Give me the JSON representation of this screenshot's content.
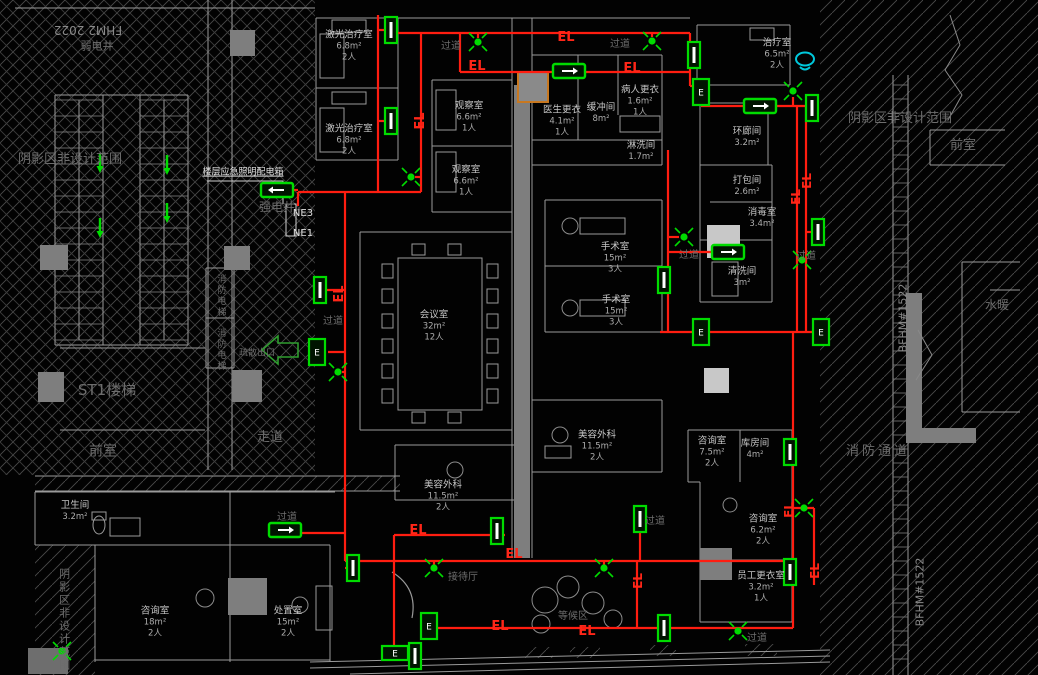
{
  "drawing": {
    "type": "emergency-lighting-floor-plan",
    "circuit_tag": "EL",
    "panel_label": "楼层应急照明配电箱",
    "feeders": [
      "NE3",
      "NE1"
    ]
  },
  "colors": {
    "circuit": "#ff1d10",
    "symbol_green": "#00dc00",
    "wall": "#9a9a9a",
    "hatch": "#4a4a4a",
    "cyan_marker": "#00c8dc",
    "orange_block": "#c87820",
    "room_text": "#c6c6c6",
    "zone_text": "#6d6d6d"
  },
  "rooms": [
    {
      "n": "激光治疗室",
      "a": "6.8m²",
      "p": "2人",
      "x": 349,
      "y": 46
    },
    {
      "n": "激光治疗室",
      "a": "6.8m²",
      "p": "2人",
      "x": 349,
      "y": 140
    },
    {
      "n": "观察室",
      "a": "6.6m²",
      "p": "1人",
      "x": 469,
      "y": 117
    },
    {
      "n": "观察室",
      "a": "6.6m²",
      "p": "1人",
      "x": 466,
      "y": 181
    },
    {
      "n": "医生更衣",
      "a": "4.1m²",
      "p": "1人",
      "x": 562,
      "y": 121
    },
    {
      "n": "缓冲间",
      "a": "8m²",
      "p": "",
      "x": 601,
      "y": 113
    },
    {
      "n": "病人更衣",
      "a": "1.6m²",
      "p": "1人",
      "x": 640,
      "y": 101
    },
    {
      "n": "淋洗间",
      "a": "1.7m²",
      "p": "",
      "x": 641,
      "y": 151
    },
    {
      "n": "治疗室",
      "a": "6.5m²",
      "p": "2人",
      "x": 777,
      "y": 54
    },
    {
      "n": "环廊间",
      "a": "3.2m²",
      "p": "",
      "x": 747,
      "y": 137
    },
    {
      "n": "打包间",
      "a": "2.6m²",
      "p": "",
      "x": 747,
      "y": 186
    },
    {
      "n": "消毒室",
      "a": "3.4m²",
      "p": "",
      "x": 762,
      "y": 218
    },
    {
      "n": "清洗间",
      "a": "3m²",
      "p": "",
      "x": 742,
      "y": 277
    },
    {
      "n": "手术室",
      "a": "15m²",
      "p": "3人",
      "x": 615,
      "y": 258
    },
    {
      "n": "手术室",
      "a": "15m²",
      "p": "3人",
      "x": 616,
      "y": 311
    },
    {
      "n": "会议室",
      "a": "32m²",
      "p": "12人",
      "x": 434,
      "y": 326
    },
    {
      "n": "美容外科",
      "a": "11.5m²",
      "p": "2人",
      "x": 597,
      "y": 446
    },
    {
      "n": "美容外科",
      "a": "11.5m²",
      "p": "2人",
      "x": 443,
      "y": 496
    },
    {
      "n": "咨询室",
      "a": "7.5m²",
      "p": "2人",
      "x": 712,
      "y": 452
    },
    {
      "n": "库房间",
      "a": "4m²",
      "p": "",
      "x": 755,
      "y": 449
    },
    {
      "n": "咨询室",
      "a": "6.2m²",
      "p": "2人",
      "x": 763,
      "y": 530
    },
    {
      "n": "员工更衣室",
      "a": "3.2m²",
      "p": "1人",
      "x": 761,
      "y": 587
    },
    {
      "n": "卫生间",
      "a": "3.2m²",
      "p": "",
      "x": 75,
      "y": 511
    },
    {
      "n": "咨询室",
      "a": "18m²",
      "p": "2人",
      "x": 155,
      "y": 622
    },
    {
      "n": "处置室",
      "a": "15m²",
      "p": "2人",
      "x": 288,
      "y": 622
    }
  ],
  "labels": [
    {
      "t": "阴影区非设计范围",
      "k": "zone",
      "s": 13,
      "x": 70,
      "y": 160
    },
    {
      "t": "阴影区非设计范围",
      "k": "zone",
      "s": 13,
      "x": 900,
      "y": 119
    },
    {
      "t": "阴影区非设计范围",
      "k": "zone",
      "s": 11,
      "x": 64,
      "y": 620,
      "vert": true
    },
    {
      "t": "前室",
      "k": "zone",
      "s": 13,
      "x": 963,
      "y": 146
    },
    {
      "t": "前室",
      "k": "zone",
      "s": 14,
      "x": 103,
      "y": 452
    },
    {
      "t": "走道",
      "k": "zone",
      "s": 13,
      "x": 270,
      "y": 438
    },
    {
      "t": "ST1楼梯",
      "k": "zone",
      "s": 15,
      "x": 107,
      "y": 390
    },
    {
      "t": "消防通道",
      "k": "zone",
      "s": 13,
      "x": 878,
      "y": 452,
      "ls": 3
    },
    {
      "t": "水暖",
      "k": "zone",
      "s": 12,
      "x": 997,
      "y": 305
    },
    {
      "t": "弱电井",
      "k": "zone",
      "s": 11,
      "x": 97,
      "y": 46
    },
    {
      "t": "强电井",
      "k": "zone",
      "s": 12,
      "x": 277,
      "y": 207
    },
    {
      "t": "消防电梯",
      "k": "zone",
      "s": 9,
      "x": 220,
      "y": 296,
      "vert": true
    },
    {
      "t": "消防电梯",
      "k": "zone",
      "s": 9,
      "x": 220,
      "y": 350,
      "vert": true
    },
    {
      "t": "疏散出口",
      "k": "zone",
      "s": 9,
      "x": 257,
      "y": 354
    },
    {
      "t": "过道",
      "k": "zone",
      "s": 10,
      "x": 451,
      "y": 47
    },
    {
      "t": "过道",
      "k": "zone",
      "s": 10,
      "x": 620,
      "y": 45
    },
    {
      "t": "过道",
      "k": "zone",
      "s": 10,
      "x": 689,
      "y": 256
    },
    {
      "t": "过道",
      "k": "zone",
      "s": 10,
      "x": 806,
      "y": 257
    },
    {
      "t": "过道",
      "k": "zone",
      "s": 10,
      "x": 333,
      "y": 322
    },
    {
      "t": "过道",
      "k": "zone",
      "s": 10,
      "x": 287,
      "y": 518
    },
    {
      "t": "过道",
      "k": "zone",
      "s": 10,
      "x": 655,
      "y": 522
    },
    {
      "t": "过道",
      "k": "zone",
      "s": 10,
      "x": 757,
      "y": 639
    },
    {
      "t": "接待厅",
      "k": "zone",
      "s": 10,
      "x": 463,
      "y": 578
    },
    {
      "t": "等候区",
      "k": "zone",
      "s": 10,
      "x": 573,
      "y": 617
    },
    {
      "t": "FHM2 2022",
      "k": "dim",
      "s": 12,
      "x": 88,
      "y": 30,
      "rot": 180
    },
    {
      "t": "BFHM#1522",
      "k": "dim",
      "s": 11,
      "x": 903,
      "y": 318,
      "rot": -90
    },
    {
      "t": "BFHM#1522",
      "k": "dim",
      "s": 11,
      "x": 920,
      "y": 592,
      "rot": -90
    },
    {
      "t": "楼层应急照明配电箱",
      "k": "sys",
      "s": 9,
      "x": 243,
      "y": 173,
      "und": true
    },
    {
      "t": "NE3",
      "k": "sys",
      "s": 10,
      "x": 303,
      "y": 214
    },
    {
      "t": "NE1",
      "k": "sys",
      "s": 10,
      "x": 303,
      "y": 234
    },
    {
      "t": "EL",
      "k": "el",
      "s": 13,
      "x": 566,
      "y": 38
    },
    {
      "t": "EL",
      "k": "el",
      "s": 13,
      "x": 477,
      "y": 67
    },
    {
      "t": "EL",
      "k": "el",
      "s": 13,
      "x": 632,
      "y": 69
    },
    {
      "t": "EL",
      "k": "el",
      "s": 13,
      "x": 421,
      "y": 121,
      "rot": -90
    },
    {
      "t": "EL",
      "k": "el",
      "s": 13,
      "x": 340,
      "y": 294,
      "rot": -90
    },
    {
      "t": "EL",
      "k": "el",
      "s": 12,
      "x": 807,
      "y": 181,
      "rot": -90
    },
    {
      "t": "EL",
      "k": "el",
      "s": 12,
      "x": 796,
      "y": 197,
      "rot": -90
    },
    {
      "t": "EL",
      "k": "el",
      "s": 12,
      "x": 789,
      "y": 510,
      "rot": -90
    },
    {
      "t": "EL",
      "k": "el",
      "s": 12,
      "x": 815,
      "y": 571,
      "rot": -90
    },
    {
      "t": "EL",
      "k": "el",
      "s": 12,
      "x": 638,
      "y": 581,
      "rot": -90
    },
    {
      "t": "EL",
      "k": "el",
      "s": 13,
      "x": 514,
      "y": 555
    },
    {
      "t": "EL",
      "k": "el",
      "s": 13,
      "x": 500,
      "y": 627
    },
    {
      "t": "EL",
      "k": "el",
      "s": 13,
      "x": 587,
      "y": 632
    },
    {
      "t": "EL",
      "k": "el",
      "s": 13,
      "x": 418,
      "y": 531
    }
  ],
  "circuit_segments": [
    [
      378,
      15,
      378,
      192
    ],
    [
      421,
      33,
      421,
      192
    ],
    [
      298,
      192,
      421,
      192
    ],
    [
      298,
      192,
      298,
      206
    ],
    [
      298,
      190,
      285,
      190
    ],
    [
      395,
      33,
      690,
      33
    ],
    [
      460,
      33,
      460,
      72
    ],
    [
      460,
      72,
      690,
      72
    ],
    [
      690,
      33,
      690,
      72
    ],
    [
      690,
      72,
      690,
      86
    ],
    [
      690,
      86,
      701,
      86
    ],
    [
      701,
      98,
      701,
      106
    ],
    [
      701,
      106,
      806,
      106
    ],
    [
      797,
      106,
      797,
      332
    ],
    [
      806,
      106,
      806,
      332
    ],
    [
      668,
      150,
      668,
      332
    ],
    [
      660,
      332,
      830,
      332
    ],
    [
      793,
      332,
      793,
      628
    ],
    [
      427,
      628,
      793,
      628
    ],
    [
      637,
      561,
      637,
      628
    ],
    [
      394,
      561,
      793,
      561
    ],
    [
      394,
      535,
      505,
      535
    ],
    [
      394,
      535,
      394,
      655
    ],
    [
      345,
      192,
      345,
      533
    ],
    [
      345,
      533,
      300,
      533
    ],
    [
      345,
      533,
      345,
      561
    ],
    [
      345,
      561,
      394,
      561
    ],
    [
      640,
      527,
      640,
      561
    ],
    [
      793,
      508,
      814,
      508
    ],
    [
      814,
      508,
      814,
      585
    ],
    [
      478,
      33,
      478,
      38
    ],
    [
      652,
      33,
      652,
      37
    ],
    [
      378,
      30,
      386,
      30
    ],
    [
      378,
      121,
      386,
      121
    ],
    [
      421,
      177,
      415,
      177
    ],
    [
      668,
      237,
      679,
      237
    ],
    [
      797,
      260,
      802,
      260
    ],
    [
      806,
      232,
      812,
      232
    ],
    [
      345,
      290,
      326,
      290
    ],
    [
      345,
      352,
      328,
      352
    ],
    [
      434,
      561,
      434,
      565
    ],
    [
      604,
      561,
      604,
      565
    ],
    [
      345,
      568,
      350,
      568
    ],
    [
      668,
      252,
      715,
      252
    ],
    [
      793,
      97,
      793,
      106
    ],
    [
      345,
      372,
      342,
      372
    ]
  ],
  "symbols": {
    "x_lights": [
      [
        478,
        42
      ],
      [
        652,
        41
      ],
      [
        411,
        177
      ],
      [
        684,
        237
      ],
      [
        802,
        260
      ],
      [
        338,
        372
      ],
      [
        434,
        568
      ],
      [
        604,
        568
      ],
      [
        804,
        508
      ],
      [
        793,
        91
      ],
      [
        738,
        631
      ],
      [
        62,
        651
      ]
    ],
    "wall_lights": [
      [
        391,
        30
      ],
      [
        391,
        121
      ],
      [
        694,
        55
      ],
      [
        812,
        108
      ],
      [
        818,
        232
      ],
      [
        664,
        280
      ],
      [
        320,
        290
      ],
      [
        790,
        452
      ],
      [
        790,
        572
      ],
      [
        640,
        519
      ],
      [
        497,
        531
      ],
      [
        664,
        628
      ],
      [
        353,
        568
      ],
      [
        415,
        656
      ]
    ],
    "exit_signs": [
      [
        277,
        190,
        "left"
      ],
      [
        569,
        71,
        "right"
      ],
      [
        760,
        106,
        "right"
      ],
      [
        728,
        252,
        "right"
      ],
      [
        285,
        530,
        "right"
      ]
    ],
    "e_boxes": [
      [
        701,
        92,
        "v"
      ],
      [
        317,
        352,
        "v"
      ],
      [
        701,
        332,
        "v"
      ],
      [
        821,
        332,
        "v"
      ],
      [
        429,
        626,
        "v"
      ],
      [
        395,
        653,
        "h"
      ]
    ],
    "e_box_letter": "E",
    "stair_arrows": [
      [
        100,
        162
      ],
      [
        167,
        164
      ],
      [
        100,
        227
      ],
      [
        167,
        212
      ]
    ],
    "big_exit_arrow": {
      "x": 262,
      "y": 350
    },
    "cyan_marker": {
      "x": 805,
      "y": 59
    }
  }
}
